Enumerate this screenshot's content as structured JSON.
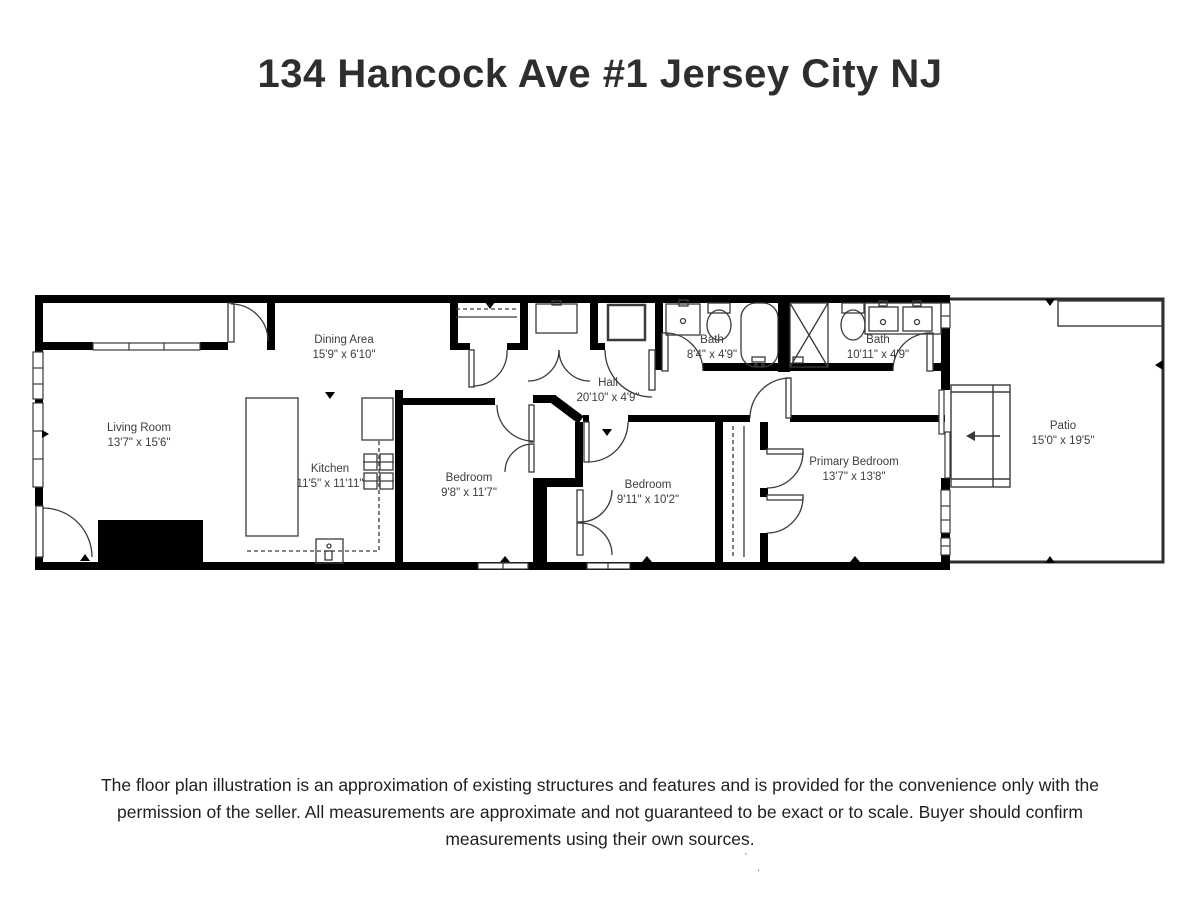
{
  "title": "134 Hancock Ave #1 Jersey City NJ",
  "disclaimer": "The floor plan illustration is an approximation of existing structures and features and is provided for the convenience only with the permission of the seller. All measurements are approximate and not guaranteed to be exact or to scale. Buyer should confirm measurements using their own sources.",
  "rooms": {
    "living": {
      "name": "Living Room",
      "dims": "13'7\" x 15'6\""
    },
    "dining": {
      "name": "Dining Area",
      "dims": "15'9\" x 6'10\""
    },
    "kitchen": {
      "name": "Kitchen",
      "dims": "11'5\" x 11'11\""
    },
    "hall": {
      "name": "Hall",
      "dims": "20'10\" x 4'9\""
    },
    "bath1": {
      "name": "Bath",
      "dims": "8'4\" x 4'9\""
    },
    "bath2": {
      "name": "Bath",
      "dims": "10'11\" x 4'9\""
    },
    "bedroom1": {
      "name": "Bedroom",
      "dims": "9'8\" x 11'7\""
    },
    "bedroom2": {
      "name": "Bedroom",
      "dims": "9'11\" x 10'2\""
    },
    "primary": {
      "name": "Primary Bedroom",
      "dims": "13'7\" x 13'8\""
    },
    "patio": {
      "name": "Patio",
      "dims": "15'0\" x 19'5\""
    }
  },
  "colors": {
    "wall": "#000000",
    "line": "#3a3a3a",
    "text": "#3d3d3d"
  },
  "artifacts": {
    "dot1": "·",
    "dot2": "."
  }
}
